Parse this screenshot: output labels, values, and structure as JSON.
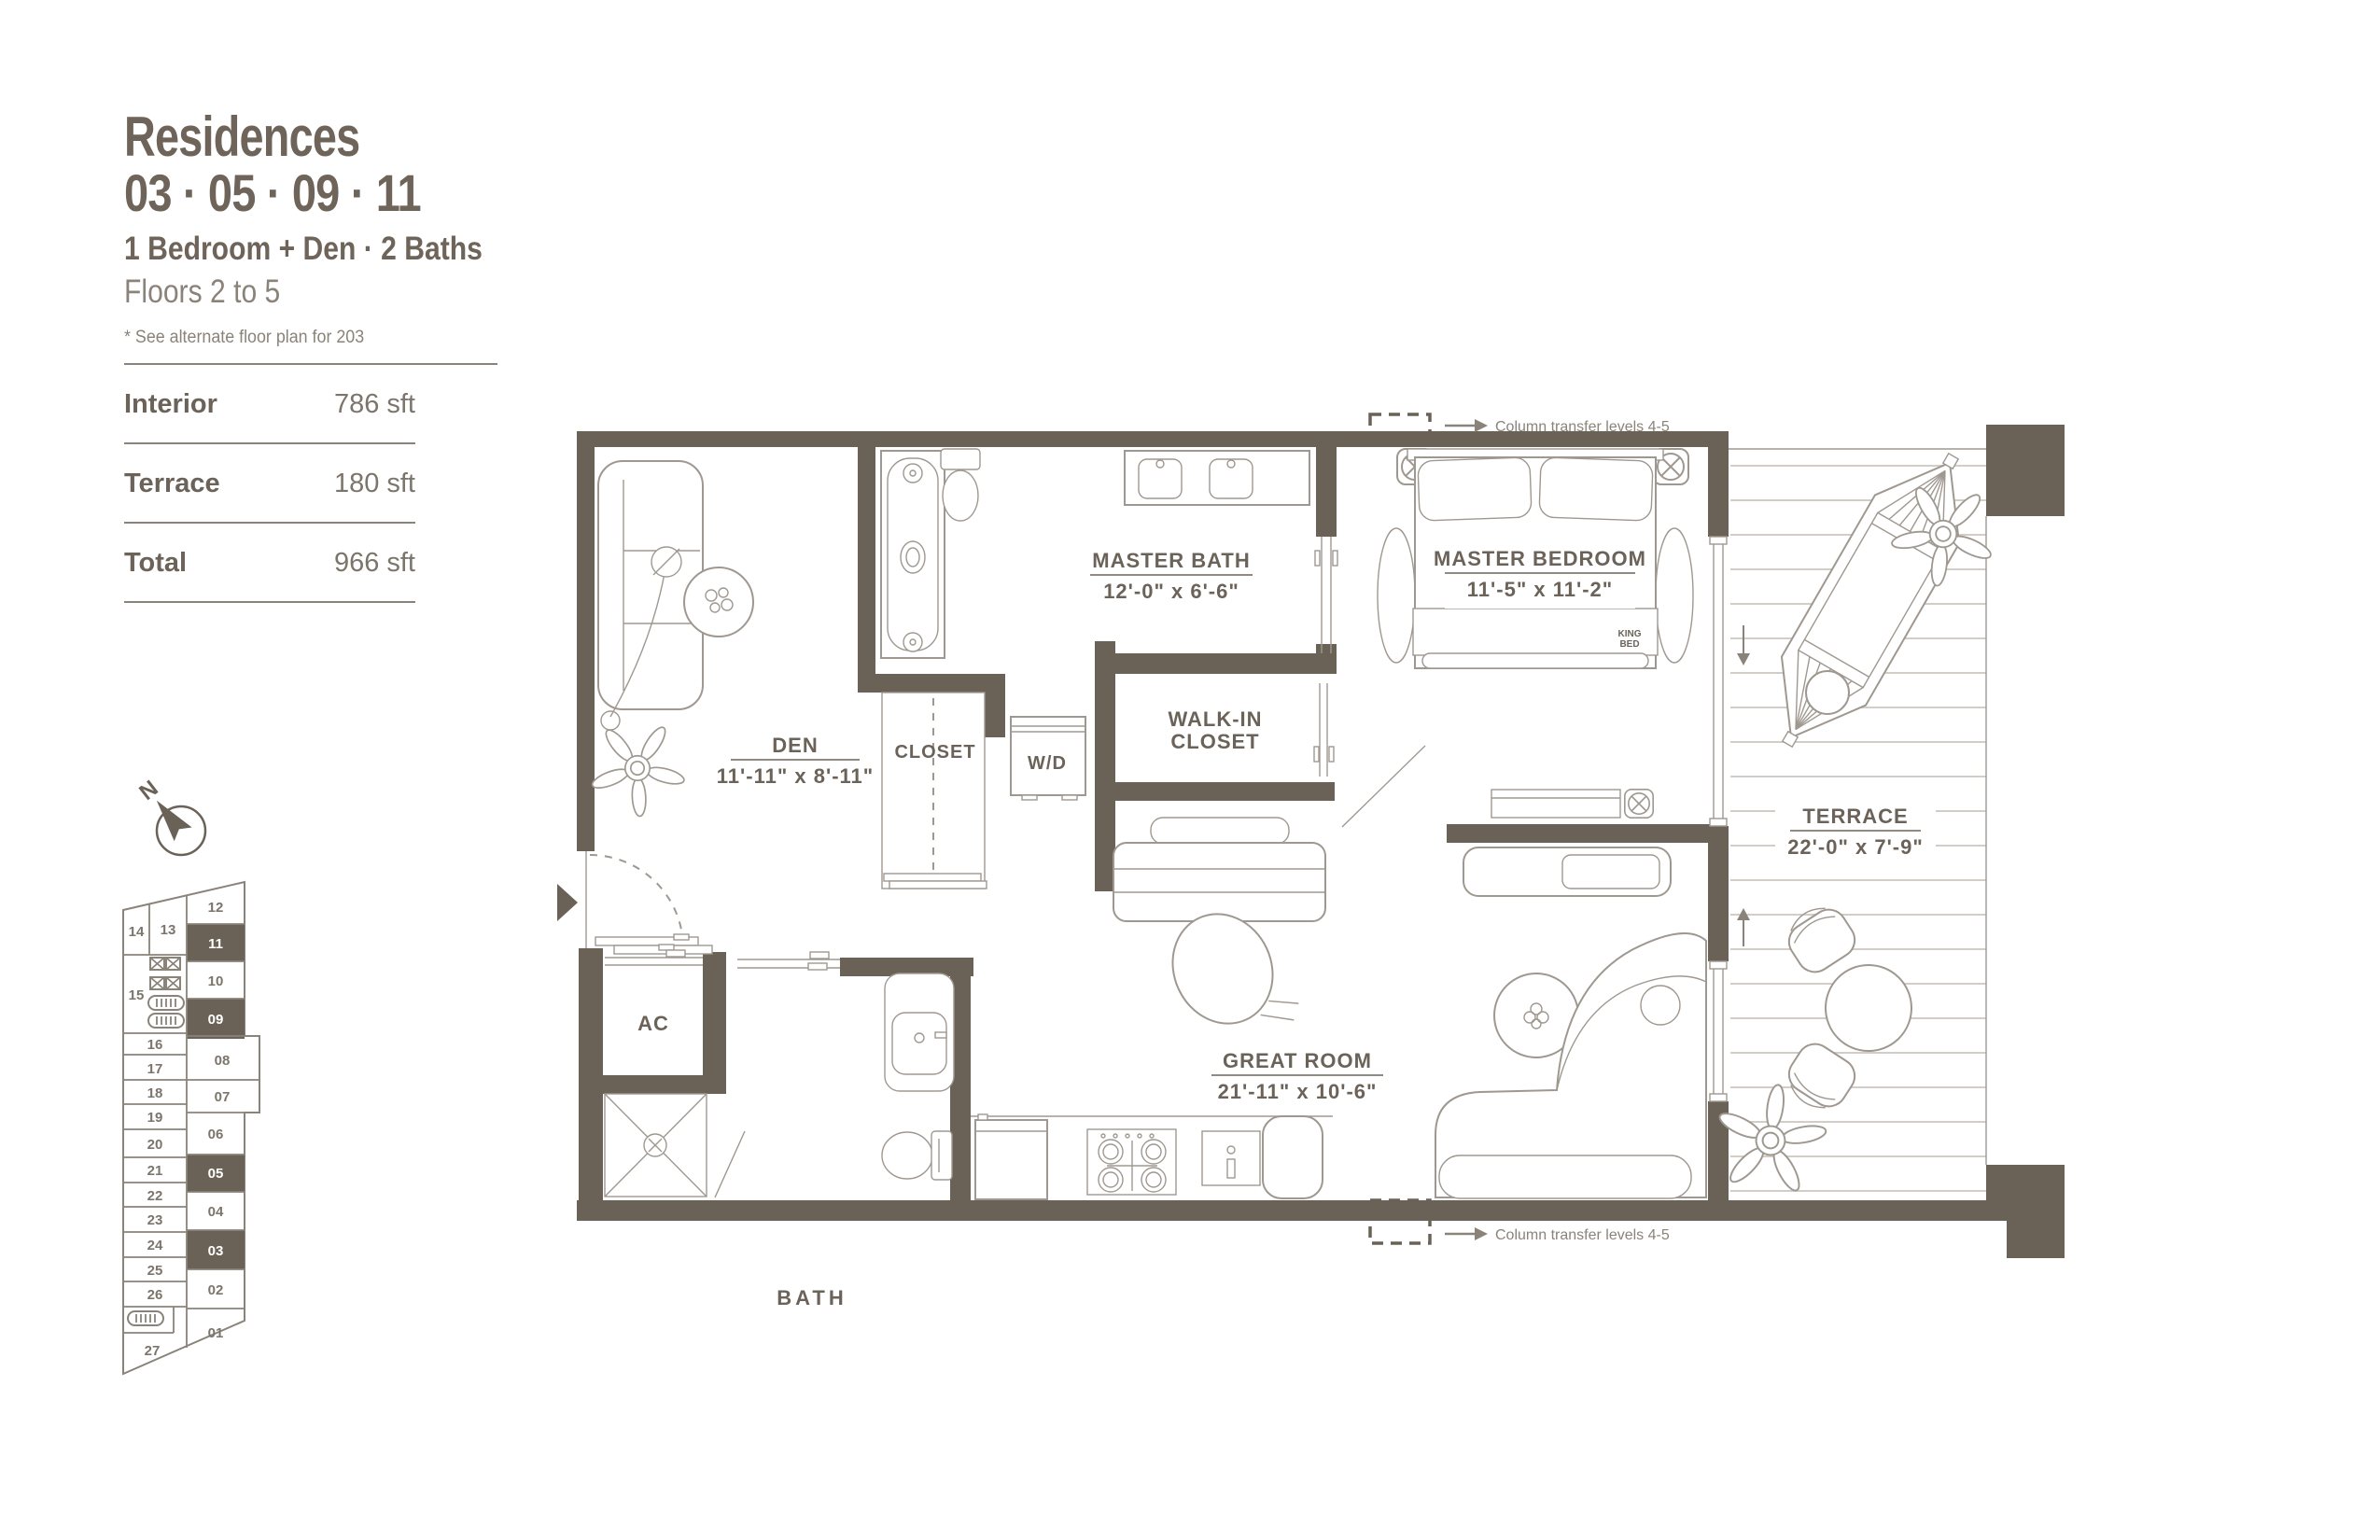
{
  "header": {
    "title": "Residences",
    "units_line": "03 · 05 · 09 · 11",
    "config_line": "1 Bedroom + Den · 2 Baths",
    "floors_line": "Floors 2 to 5",
    "note": "* See alternate floor plan for 203"
  },
  "areas": {
    "rows": [
      {
        "label": "Interior",
        "value": "786 sft"
      },
      {
        "label": "Terrace",
        "value": "180 sft"
      },
      {
        "label": "Total",
        "value": "966 sft"
      }
    ]
  },
  "compass": {
    "n": "N"
  },
  "keyplan": {
    "highlighted": [
      "11",
      "09",
      "05",
      "03"
    ],
    "highlight_color": "#6b6257",
    "right_units": [
      "12",
      "11",
      "10",
      "09",
      "08",
      "07",
      "06",
      "05",
      "04",
      "03",
      "02",
      "01"
    ],
    "left_units": [
      "14",
      "13",
      "15",
      "16",
      "17",
      "18",
      "19",
      "20",
      "21",
      "22",
      "23",
      "24",
      "25",
      "26",
      "27"
    ]
  },
  "plan": {
    "rooms": {
      "master_bath": {
        "name": "MASTER BATH",
        "dims": "12'-0\" x 6'-6\""
      },
      "master_bedroom": {
        "name": "MASTER BEDROOM",
        "dims": "11'-5\" x 11'-2\""
      },
      "den": {
        "name": "DEN",
        "dims": "11'-11\" x 8'-11\""
      },
      "great_room": {
        "name": "GREAT ROOM",
        "dims": "21'-11\" x 10'-6\""
      },
      "terrace": {
        "name": "TERRACE",
        "dims": "22'-0\" x 7'-9\""
      },
      "walk_in": {
        "line1": "WALK-IN",
        "line2": "CLOSET"
      },
      "closet": {
        "name": "CLOSET"
      },
      "wd": {
        "name": "W/D"
      },
      "ac": {
        "name": "AC"
      },
      "bath": {
        "name": "BATH"
      }
    },
    "king_bed": {
      "line1": "KING",
      "line2": "BED"
    },
    "column_note": "Column transfer levels  4-5"
  },
  "colors": {
    "wall": "#6b6257",
    "linework": "#9f9890",
    "text": "#6b6359",
    "muted_text": "#8a8379",
    "deck_line": "#d2cdc6"
  }
}
